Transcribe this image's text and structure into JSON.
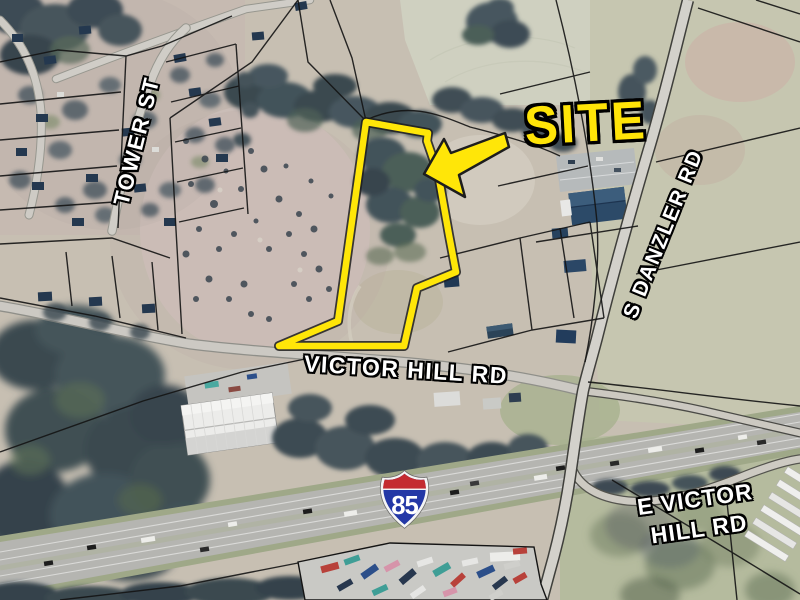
{
  "meta": {
    "width": 800,
    "height": 600,
    "description": "Aerial site location map with highlighted parcel"
  },
  "map": {
    "site_label": "SITE",
    "roads": {
      "tower_st": "TOWER ST",
      "s_danzler_rd": "S DANZLER RD",
      "victor_hill_rd": "VICTOR HILL RD",
      "e_victor_hill_rd": {
        "line1": "E VICTOR",
        "line2": "HILL RD"
      }
    },
    "interstate_shield": {
      "number": "85"
    },
    "colors": {
      "site_outline": "#FFE608",
      "site_label_fill": "#FFE408",
      "road_label_fill": "#FFFFFF",
      "label_outline": "#000000",
      "shield_blue": "#2438A6",
      "shield_red": "#C42B30",
      "shield_border": "#F4F4F4",
      "parcel_line": "#141414"
    }
  }
}
